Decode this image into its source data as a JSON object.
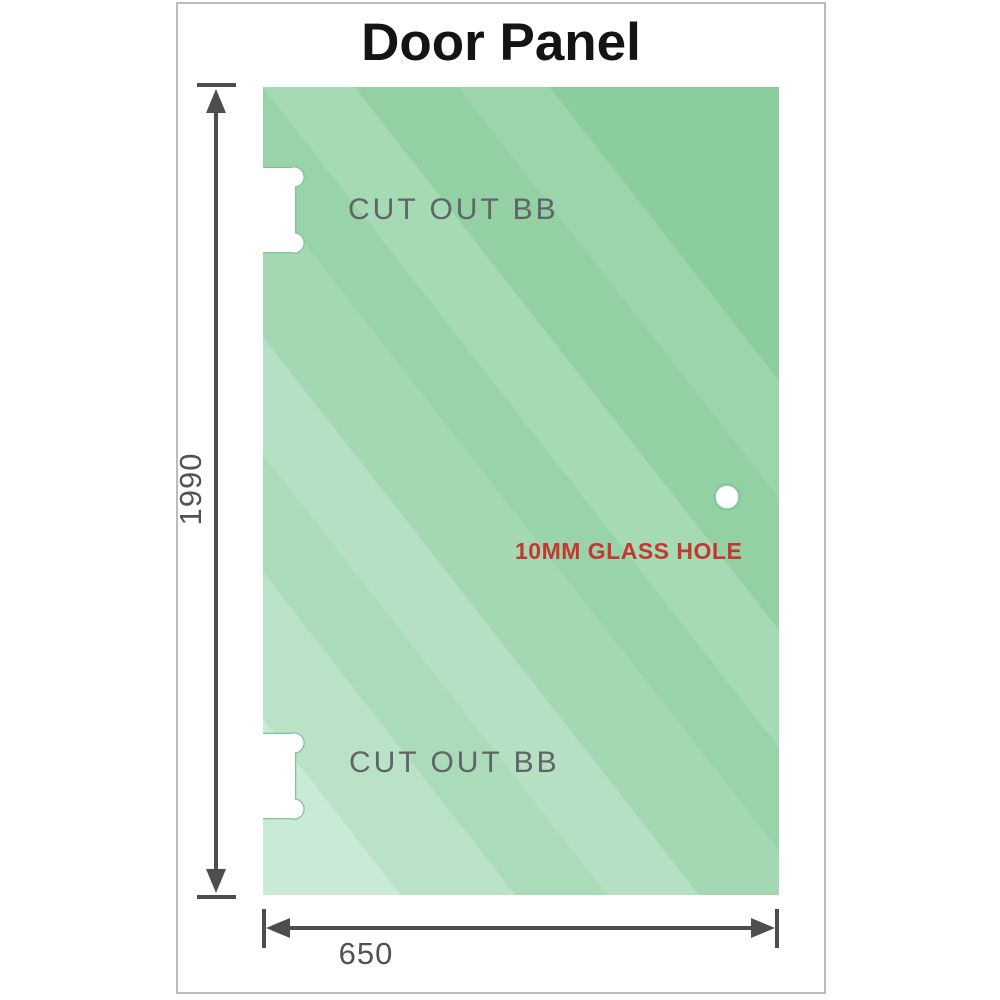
{
  "title": "Door Panel",
  "panel": {
    "cutout_top_label": "CUT OUT BB",
    "cutout_bottom_label": "CUT OUT BB",
    "hole_label": "10MM GLASS HOLE"
  },
  "dimensions": {
    "height_label": "1990",
    "width_label": "650"
  },
  "colors": {
    "glass_light": "#c9ead4",
    "glass_dark": "#8ccd9e",
    "cutout_outline_green": "#7fc497",
    "hole_label_red": "#c53830",
    "dimension_grey": "#4d4d4d",
    "cutout_label_grey": "#5f6567",
    "frame_border_grey": "#bcbcbc"
  }
}
